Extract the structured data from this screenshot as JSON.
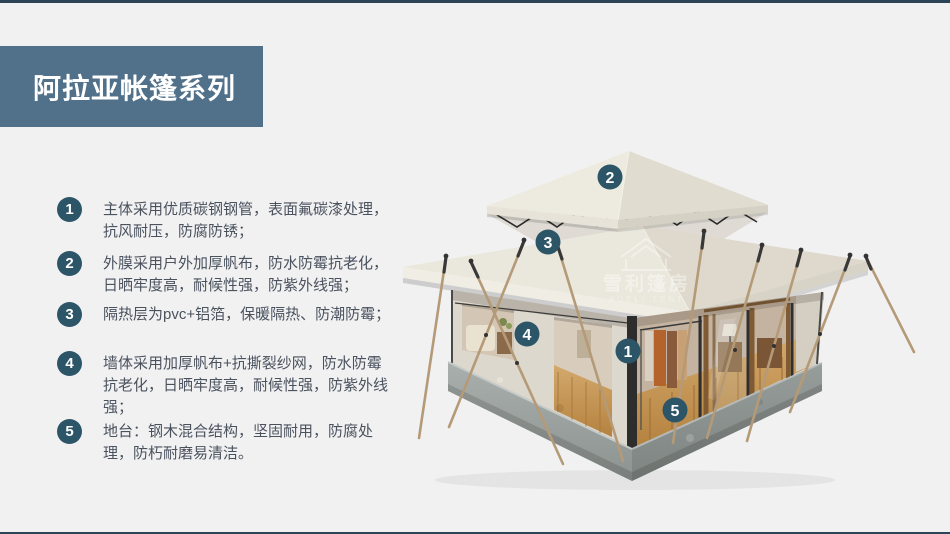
{
  "page": {
    "background": "#f1f1f2",
    "accent_bar_color": "#2c4456",
    "banner_color": "#51708a",
    "badge_color": "#2d5568",
    "text_color": "#4a525e"
  },
  "header": {
    "title": "阿拉亚帐篷系列"
  },
  "features": [
    {
      "num": "1",
      "text": "主体采用优质碳钢钢管，表面氟碳漆处理，抗风耐压，防腐防锈；"
    },
    {
      "num": "2",
      "text": "外膜采用户外加厚帆布，防水防霉抗老化，日晒牢度高，耐候性强，防紫外线强；"
    },
    {
      "num": "3",
      "text": "隔热层为pvc+铝箔，保暖隔热、防潮防霉；"
    },
    {
      "num": "4",
      "text": "墙体采用加厚帆布+抗撕裂纱网，防水防霉抗老化，日晒牢度高，耐候性强，防紫外线强；"
    },
    {
      "num": "5",
      "text": "地台：钢木混合结构，坚固耐用，防腐处理，防朽耐磨易清洁。"
    }
  ],
  "diagram": {
    "subject": "两层顶帐篷三维效果图",
    "markers": [
      {
        "num": "1",
        "part": "frame-wall-corner"
      },
      {
        "num": "2",
        "part": "top-roof"
      },
      {
        "num": "3",
        "part": "main-roof"
      },
      {
        "num": "4",
        "part": "canvas-wall"
      },
      {
        "num": "5",
        "part": "deck-platform"
      }
    ],
    "watermark": {
      "cn": "雪利篷房",
      "en": "XUELI TENT"
    }
  }
}
